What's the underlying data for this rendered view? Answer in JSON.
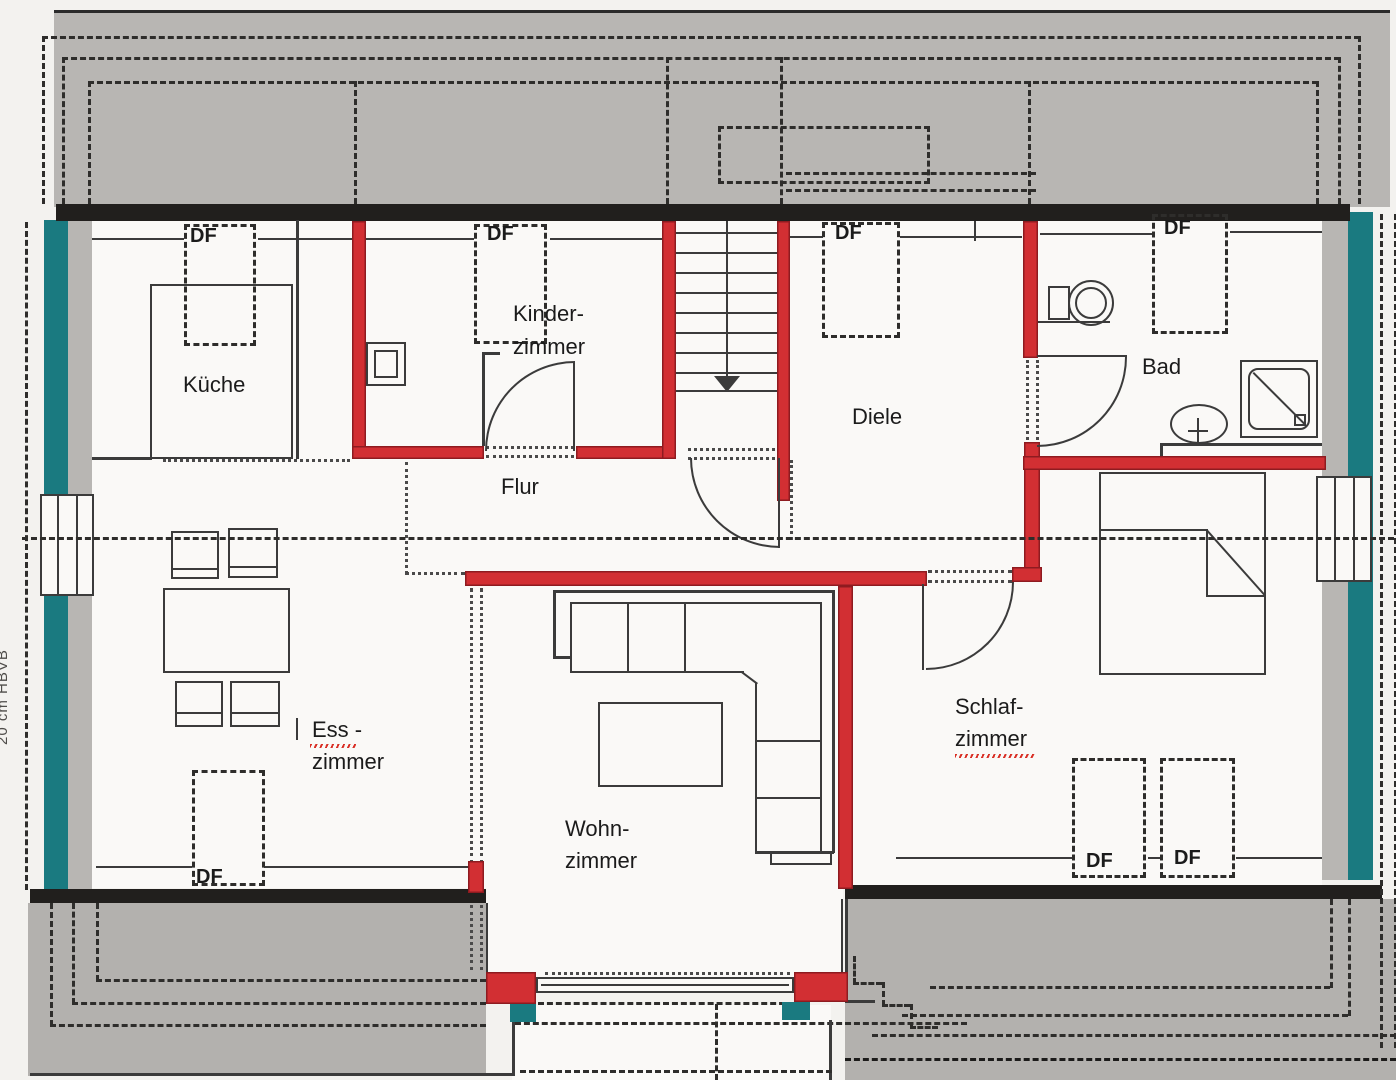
{
  "colors": {
    "wall_red": "#d22f33",
    "wall_red_edge": "#8e1b20",
    "window_teal": "#1a7a80",
    "roof_gray": "#b8b6b3",
    "roof_gray_bottom": "#b3b1ae",
    "band_black": "#211f1d",
    "line_dark": "#3b3b3b",
    "dash_dark": "#2e2d2b",
    "dot_dark": "#4a4a4a",
    "paper": "#faf9f7",
    "canvas_bg": "#f3f2ef",
    "text": "#1b1b1b",
    "spell_red": "#d93026"
  },
  "labels": {
    "rooms": {
      "kueche": "Küche",
      "kinder_line1": "Kinder-",
      "kinder_line2": "zimmer",
      "diele": "Diele",
      "bad": "Bad",
      "flur": "Flur",
      "ess_line1": "Ess -",
      "ess_line2": "zimmer",
      "wohn_line1": "Wohn-",
      "wohn_line2": "zimmer",
      "schlaf_line1": "Schlaf-",
      "schlaf_line2": "zimmer"
    },
    "roof_window": "DF",
    "margin_note": "20 cm HBVB"
  }
}
